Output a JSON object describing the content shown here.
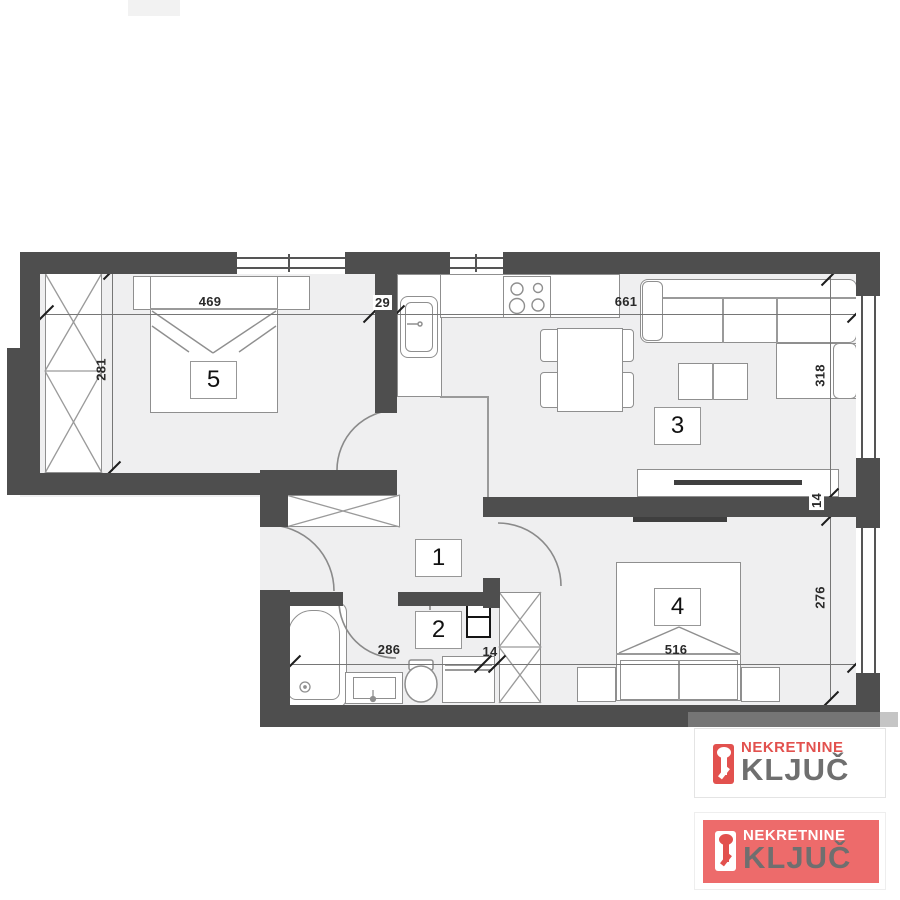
{
  "colors": {
    "wall": "#4e4e4e",
    "floor": "#efeff0",
    "furniture_outline": "#8f8f8f",
    "logo_red": "#e2514e",
    "logo_card_red_bg": "#ed6b6b",
    "logo_gray_text": "#6f6f6f"
  },
  "rooms": [
    {
      "label": "1"
    },
    {
      "label": "2"
    },
    {
      "label": "3"
    },
    {
      "label": "4"
    },
    {
      "label": "5"
    }
  ],
  "dimensions": {
    "room5_width": "469",
    "room5_height": "281",
    "kitchen_wall": "29",
    "living_width": "661",
    "living_height": "318",
    "right_wall": "14",
    "room4_height": "276",
    "bath_width": "286",
    "bath_wall": "14",
    "room4_width": "516"
  },
  "watermark": {
    "badge_light": {
      "line1": "NEKRETNINE",
      "line2": "KLJUČ"
    },
    "badge_red": {
      "line1": "NEKRETNINE",
      "line2": "KLJUČ"
    }
  }
}
